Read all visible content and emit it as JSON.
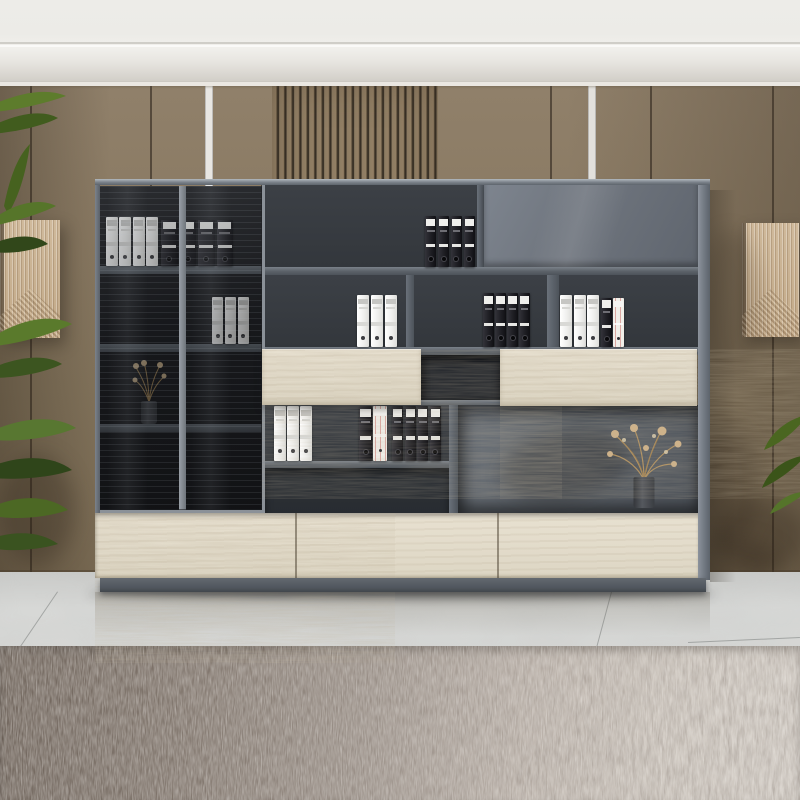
{
  "scene": {
    "description": "office wall cabinet with glass doors, grey shelving, oak drawers, binders, dried flowers, plant, marble floor and rug"
  },
  "palette": {
    "ceiling": "#ecebe7",
    "wall_tan": "#8d7d66",
    "wall_tan_dark": "#796a53",
    "slat_gap": "#2e271f",
    "white_strip": "#e8e6e2",
    "art_beige": "#c9b294",
    "cabinet_grey": "#5b6168",
    "cabinet_interior": "#34383d",
    "grey_door": "#70767f",
    "glass": "#191a1d",
    "wood_light": "#e0d9c8",
    "binder_white": "#f3f3f2",
    "binder_black": "#232327",
    "stripe_accent": "#dba8a2",
    "floor_marble": "#d4d5d3",
    "rug_dark": "#6b6057",
    "rug_light": "#d3cdc6",
    "plant_green": "#52702a",
    "dried_flowers": "#c2996a",
    "plinth_grey": "#596067"
  },
  "ceiling": {
    "rect": [
      0,
      0,
      800,
      86
    ]
  },
  "wall": {
    "rect": [
      0,
      86,
      800,
      486
    ],
    "top_y": 86,
    "floor_y": 572,
    "seams_x": [
      30,
      150,
      550,
      650,
      772
    ],
    "white_strips_x": [
      205,
      588
    ],
    "slat_region": [
      272,
      86,
      166,
      486
    ]
  },
  "art_panels": [
    {
      "name": "wall-art-left",
      "rect": [
        0,
        220,
        60,
        118
      ]
    },
    {
      "name": "wall-art-right",
      "rect": [
        742,
        223,
        57,
        114
      ]
    }
  ],
  "plants": [
    {
      "name": "potted-plant-left",
      "rect": [
        0,
        86,
        112,
        486
      ]
    },
    {
      "name": "plant-leaves-right",
      "rect": [
        756,
        396,
        44,
        118
      ]
    }
  ],
  "cabinet": {
    "rect": [
      95,
      179,
      615,
      413
    ],
    "glass_frame": [
      95,
      181,
      170,
      332
    ],
    "glass_backdrop": [
      99,
      186,
      163,
      324
    ],
    "glass_shelf_1": [
      100,
      266,
      162,
      8
    ],
    "glass_shelf_2": [
      100,
      344,
      162,
      8
    ],
    "glass_shelf_3": [
      100,
      424,
      162,
      8
    ],
    "glass_door_left": [
      99,
      186,
      81,
      324
    ],
    "glass_door_right": [
      183,
      186,
      80,
      324
    ],
    "mullion": [
      179,
      186,
      7,
      324
    ],
    "row1_bay": [
      265,
      185,
      212,
      82
    ],
    "divider_r1": [
      477,
      185,
      7,
      90
    ],
    "grey_door": [
      484,
      181,
      214,
      86
    ],
    "shelf1": [
      265,
      267,
      433,
      8
    ],
    "bay_r2a": [
      265,
      275,
      141,
      72
    ],
    "bay_r2b": [
      414,
      275,
      133,
      72
    ],
    "bay_r2c": [
      559,
      275,
      139,
      72
    ],
    "divider_r2a": [
      406,
      275,
      8,
      80
    ],
    "divider_r2b": [
      547,
      275,
      12,
      80
    ],
    "shelf2": [
      265,
      347,
      433,
      8
    ],
    "wood_panel_left": [
      262,
      349,
      159,
      56
    ],
    "wood_panel_right": [
      500,
      349,
      197,
      57
    ],
    "mid_box": [
      421,
      355,
      79,
      45
    ],
    "mid_box_sill": [
      421,
      400,
      79,
      8
    ],
    "row4_bay": [
      265,
      405,
      184,
      56
    ],
    "shelf3": [
      265,
      461,
      184,
      7
    ],
    "row4_lower": [
      265,
      468,
      184,
      45
    ],
    "divider4": [
      449,
      405,
      9,
      108
    ],
    "niche": [
      458,
      405,
      240,
      108
    ],
    "drawers": [
      95,
      513,
      605,
      65
    ],
    "drawer_seams_x": [
      295,
      497
    ],
    "left_edge": [
      95,
      181,
      5,
      332
    ],
    "top_edge": [
      95,
      179,
      615,
      6
    ],
    "side_panel": [
      698,
      180,
      12,
      400
    ],
    "plinth": [
      100,
      578,
      606,
      14
    ]
  },
  "binder_groups": [
    {
      "name": "white-binders-glass-top",
      "rect": [
        106,
        217,
        52,
        49
      ],
      "count": 4,
      "style": "white",
      "gap": 1.5,
      "layer": "glass"
    },
    {
      "name": "black-binders-glass-top",
      "rect": [
        161,
        220,
        72,
        46
      ],
      "count": 4,
      "style": "black",
      "gap": 2,
      "layer": "glass"
    },
    {
      "name": "white-binders-glass-middle",
      "rect": [
        212,
        297,
        37,
        47
      ],
      "count": 3,
      "style": "white",
      "gap": 1.5,
      "layer": "glass"
    },
    {
      "name": "black-binders-top-shelf",
      "rect": [
        425,
        216,
        50,
        51
      ],
      "count": 4,
      "style": "black",
      "gap": 1.5,
      "layer": "open"
    },
    {
      "name": "white-binders-row2-left",
      "rect": [
        357,
        295,
        40,
        52
      ],
      "count": 3,
      "style": "white",
      "gap": 1.5,
      "layer": "open"
    },
    {
      "name": "black-binders-row2-middle",
      "rect": [
        483,
        293,
        47,
        54
      ],
      "count": 4,
      "style": "black",
      "gap": 1,
      "layer": "open"
    },
    {
      "name": "white-binders-row2-right",
      "rect": [
        560,
        295,
        39,
        52
      ],
      "count": 3,
      "style": "white",
      "gap": 1.5,
      "layer": "open"
    },
    {
      "name": "black-binder-row2-right",
      "rect": [
        601,
        298,
        11,
        49
      ],
      "count": 1,
      "style": "black",
      "gap": 0,
      "layer": "open"
    },
    {
      "name": "striped-binder-row2-right",
      "rect": [
        613,
        298,
        11,
        49
      ],
      "count": 1,
      "style": "stripe",
      "gap": 0,
      "layer": "open"
    },
    {
      "name": "white-binders-row4",
      "rect": [
        274,
        406,
        38,
        55
      ],
      "count": 3,
      "style": "white",
      "gap": 1.5,
      "layer": "open"
    },
    {
      "name": "black-binder-row4",
      "rect": [
        359,
        406,
        13,
        55
      ],
      "count": 1,
      "style": "black",
      "gap": 0,
      "layer": "open"
    },
    {
      "name": "striped-binder-row4",
      "rect": [
        373,
        406,
        14,
        55
      ],
      "count": 1,
      "style": "stripe",
      "gap": 0,
      "layer": "open"
    },
    {
      "name": "black-binders-row4",
      "rect": [
        392,
        406,
        49,
        55
      ],
      "count": 4,
      "style": "black",
      "gap": 1.5,
      "layer": "open"
    }
  ],
  "vases": [
    {
      "name": "vase-with-dried-flowers-glass",
      "rect": [
        130,
        356,
        38,
        68
      ]
    },
    {
      "name": "vase-with-dried-flowers-niche",
      "rect": [
        598,
        420,
        92,
        88
      ]
    }
  ],
  "floor": {
    "rect": [
      0,
      572,
      800,
      228
    ],
    "tile_seams": [
      [
        58,
        592,
        20,
        648
      ],
      [
        612,
        592,
        597,
        648
      ],
      [
        688,
        642,
        800,
        637
      ]
    ]
  },
  "rug": {
    "rect": [
      0,
      646,
      800,
      154
    ]
  }
}
